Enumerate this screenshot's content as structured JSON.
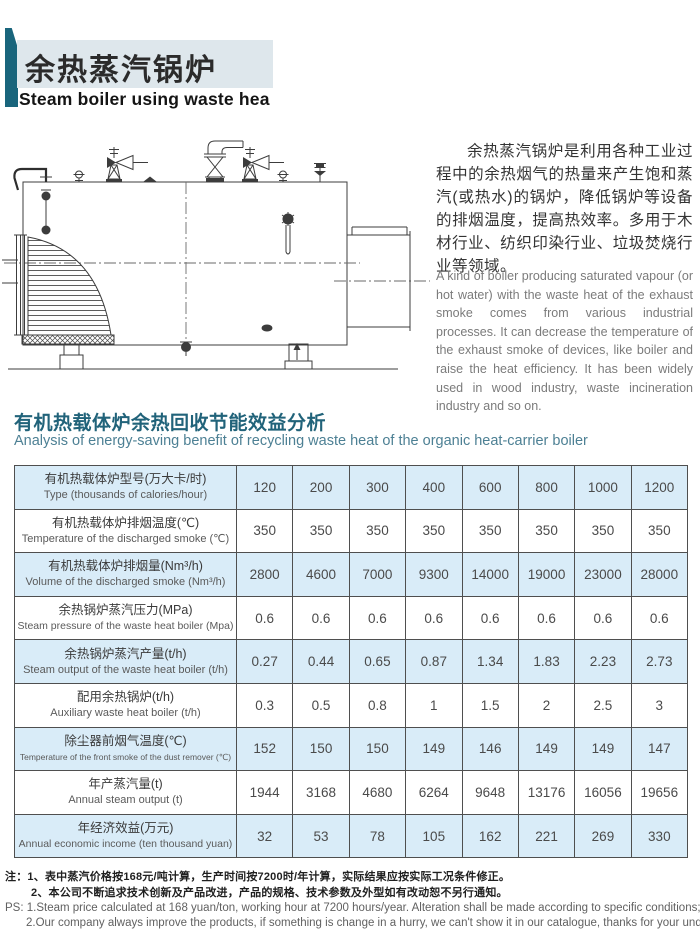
{
  "header": {
    "title_zh": "余热蒸汽锅炉",
    "title_en": "Steam boiler using waste hea"
  },
  "intro": {
    "zh": "余热蒸汽锅炉是利用各种工业过程中的余热烟气的热量来产生饱和蒸汽(或热水)的锅炉，降低锅炉等设备的排烟温度，提高热效率。多用于木材行业、纺织印染行业、垃圾焚烧行业等领域。",
    "en": "A kind of boiler producing saturated vapour (or hot water) with the waste heat of the exhaust smoke comes from various industrial processes. It can decrease the temperature of the exhaust smoke of devices, like boiler and raise the heat efficiency. It has been widely used in wood industry, waste incineration industry and so on."
  },
  "section": {
    "zh": "有机热载体炉余热回收节能效益分析",
    "en": "Analysis of energy-saving benefit of recycling waste heat of the organic heat-carrier boiler"
  },
  "diagram": {
    "name": "waste-heat-steam-boiler-side-view"
  },
  "table": {
    "rows": [
      {
        "zh": "有机热载体炉型号(万大卡/时)",
        "en": "Type (thousands of calories/hour)",
        "values": [
          "120",
          "200",
          "300",
          "400",
          "600",
          "800",
          "1000",
          "1200"
        ]
      },
      {
        "zh": "有机热载体炉排烟温度(℃)",
        "en": "Temperature of the discharged smoke (℃)",
        "values": [
          "350",
          "350",
          "350",
          "350",
          "350",
          "350",
          "350",
          "350"
        ]
      },
      {
        "zh": "有机热载体炉排烟量(Nm³/h)",
        "en": "Volume of the discharged smoke (Nm³/h)",
        "values": [
          "2800",
          "4600",
          "7000",
          "9300",
          "14000",
          "19000",
          "23000",
          "28000"
        ]
      },
      {
        "zh": "余热锅炉蒸汽压力(MPa)",
        "en": "Steam pressure of the waste heat boiler (Mpa)",
        "values": [
          "0.6",
          "0.6",
          "0.6",
          "0.6",
          "0.6",
          "0.6",
          "0.6",
          "0.6"
        ]
      },
      {
        "zh": "余热锅炉蒸汽产量(t/h)",
        "en": "Steam output of the waste heat boiler (t/h)",
        "values": [
          "0.27",
          "0.44",
          "0.65",
          "0.87",
          "1.34",
          "1.83",
          "2.23",
          "2.73"
        ]
      },
      {
        "zh": "配用余热锅炉(t/h)",
        "en": "Auxiliary waste heat boiler (t/h)",
        "values": [
          "0.3",
          "0.5",
          "0.8",
          "1",
          "1.5",
          "2",
          "2.5",
          "3"
        ]
      },
      {
        "zh": "除尘器前烟气温度(℃)",
        "en": "Temperature of the front smoke of the dust remover (℃)",
        "values": [
          "152",
          "150",
          "150",
          "149",
          "146",
          "149",
          "149",
          "147"
        ]
      },
      {
        "zh": "年产蒸汽量(t)",
        "en": "Annual steam output (t)",
        "values": [
          "1944",
          "3168",
          "4680",
          "6264",
          "9648",
          "13176",
          "16056",
          "19656"
        ]
      },
      {
        "zh": "年经济效益(万元)",
        "en": "Annual economic income (ten thousand yuan)",
        "values": [
          "32",
          "53",
          "78",
          "105",
          "162",
          "221",
          "269",
          "330"
        ]
      }
    ]
  },
  "notes": {
    "zh1_label": "注：",
    "zh1_num": "1、",
    "zh1": "表中蒸汽价格按168元/吨计算，生产时间按7200时/年计算，实际结果应按实际工况条件修正。",
    "zh2_num": "2、",
    "zh2": "本公司不断追求技术创新及产品改进，产品的规格、技术参数及外型如有改动恕不另行通知。",
    "ps_label": "PS:",
    "ps1": "1.Steam price calculated at 168 yuan/ton, working hour at 7200 hours/year. Alteration shall be made according to specific conditions;",
    "ps2": "2.Our company always improve the products, if something is change in a hurry, we can't show it in our catalogue, thanks for your understanding."
  },
  "colors": {
    "accent_teal": "#19657c",
    "title_bg": "#dee7ec",
    "heading_teal": "#21637a",
    "table_row_blue": "#d9ecf8",
    "table_border": "#4f4f4f"
  }
}
